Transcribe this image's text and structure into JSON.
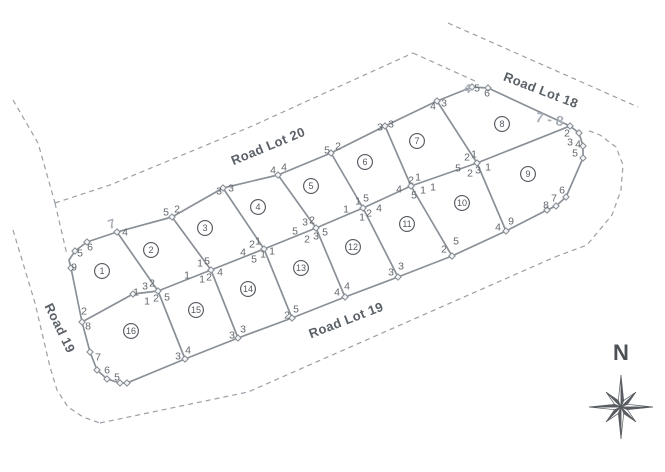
{
  "page": {
    "background": "#ffffff"
  },
  "colors": {
    "line": "#8a9097",
    "dashed": "#9aa0a7",
    "marker_fill": "#f6f7f8",
    "corner_text": "#62676d",
    "lot_text": "#54585e",
    "road_text": "#5a6067",
    "handwritten": "#aab0b8",
    "compass": "#595d62"
  },
  "roads": [
    {
      "label": "Road Lot 20",
      "x": 268,
      "y": 146,
      "rot": -22.5
    },
    {
      "label": "Road Lot 18",
      "x": 541,
      "y": 90,
      "rot": 21
    },
    {
      "label": "Road Lot 19",
      "x": 346,
      "y": 320,
      "rot": -21
    },
    {
      "label": "Road 19",
      "x": 60,
      "y": 328,
      "rot": 64
    }
  ],
  "compass": {
    "label": "N",
    "cx": 621,
    "cy": 407,
    "label_x": 621,
    "label_y": 353,
    "r_long": 32,
    "r_short": 21,
    "r_base": 7
  },
  "lots": [
    {
      "n": "1",
      "x": 102,
      "y": 271
    },
    {
      "n": "2",
      "x": 151,
      "y": 250
    },
    {
      "n": "3",
      "x": 205,
      "y": 228
    },
    {
      "n": "4",
      "x": 258,
      "y": 207
    },
    {
      "n": "5",
      "x": 311,
      "y": 186
    },
    {
      "n": "6",
      "x": 365,
      "y": 162
    },
    {
      "n": "7",
      "x": 417,
      "y": 141
    },
    {
      "n": "8",
      "x": 502,
      "y": 124
    },
    {
      "n": "9",
      "x": 528,
      "y": 174
    },
    {
      "n": "10",
      "x": 462,
      "y": 203
    },
    {
      "n": "11",
      "x": 407,
      "y": 224
    },
    {
      "n": "12",
      "x": 353,
      "y": 247
    },
    {
      "n": "13",
      "x": 301,
      "y": 268
    },
    {
      "n": "14",
      "x": 248,
      "y": 289
    },
    {
      "n": "15",
      "x": 196,
      "y": 310
    },
    {
      "n": "16",
      "x": 131,
      "y": 331
    }
  ],
  "corner_labels": [
    {
      "x": 80,
      "y": 253,
      "t": "5"
    },
    {
      "x": 90,
      "y": 247,
      "t": "6"
    },
    {
      "x": 74,
      "y": 267,
      "t": "9"
    },
    {
      "x": 125,
      "y": 232,
      "t": "4"
    },
    {
      "x": 166,
      "y": 212,
      "t": "5"
    },
    {
      "x": 177,
      "y": 209,
      "t": "2"
    },
    {
      "x": 219,
      "y": 191,
      "t": "3"
    },
    {
      "x": 231,
      "y": 188,
      "t": "3"
    },
    {
      "x": 273,
      "y": 170,
      "t": "4"
    },
    {
      "x": 284,
      "y": 167,
      "t": "4"
    },
    {
      "x": 327,
      "y": 150,
      "t": "5"
    },
    {
      "x": 338,
      "y": 146,
      "t": "2"
    },
    {
      "x": 380,
      "y": 127,
      "t": "3"
    },
    {
      "x": 391,
      "y": 124,
      "t": "3"
    },
    {
      "x": 433,
      "y": 106,
      "t": "4"
    },
    {
      "x": 444,
      "y": 103,
      "t": "3"
    },
    {
      "x": 477,
      "y": 88,
      "t": "5"
    },
    {
      "x": 487,
      "y": 93,
      "t": "6"
    },
    {
      "x": 567,
      "y": 133,
      "t": "2"
    },
    {
      "x": 570,
      "y": 142,
      "t": "3"
    },
    {
      "x": 578,
      "y": 144,
      "t": "4"
    },
    {
      "x": 575,
      "y": 153,
      "t": "5"
    },
    {
      "x": 562,
      "y": 190,
      "t": "6"
    },
    {
      "x": 554,
      "y": 198,
      "t": "7"
    },
    {
      "x": 546,
      "y": 205,
      "t": "8"
    },
    {
      "x": 511,
      "y": 221,
      "t": "9"
    },
    {
      "x": 498,
      "y": 227,
      "t": "4"
    },
    {
      "x": 456,
      "y": 241,
      "t": "5"
    },
    {
      "x": 444,
      "y": 249,
      "t": "2"
    },
    {
      "x": 401,
      "y": 266,
      "t": "3"
    },
    {
      "x": 391,
      "y": 272,
      "t": "3"
    },
    {
      "x": 347,
      "y": 286,
      "t": "4"
    },
    {
      "x": 337,
      "y": 292,
      "t": "4"
    },
    {
      "x": 296,
      "y": 309,
      "t": "5"
    },
    {
      "x": 287,
      "y": 315,
      "t": "2"
    },
    {
      "x": 243,
      "y": 329,
      "t": "3"
    },
    {
      "x": 232,
      "y": 335,
      "t": "3"
    },
    {
      "x": 188,
      "y": 350,
      "t": "4"
    },
    {
      "x": 178,
      "y": 356,
      "t": "3"
    },
    {
      "x": 117,
      "y": 377,
      "t": "5"
    },
    {
      "x": 107,
      "y": 370,
      "t": "6"
    },
    {
      "x": 98,
      "y": 357,
      "t": "7"
    },
    {
      "x": 88,
      "y": 326,
      "t": "8"
    },
    {
      "x": 84,
      "y": 311,
      "t": "2"
    },
    {
      "x": 136,
      "y": 292,
      "t": "1"
    },
    {
      "x": 145,
      "y": 286,
      "t": "3"
    },
    {
      "x": 152,
      "y": 283,
      "t": "2"
    },
    {
      "x": 147,
      "y": 301,
      "t": "1"
    },
    {
      "x": 156,
      "y": 298,
      "t": "2"
    },
    {
      "x": 167,
      "y": 297,
      "t": "5"
    },
    {
      "x": 187,
      "y": 275,
      "t": "1"
    },
    {
      "x": 200,
      "y": 263,
      "t": "1"
    },
    {
      "x": 207,
      "y": 261,
      "t": "5"
    },
    {
      "x": 202,
      "y": 279,
      "t": "1"
    },
    {
      "x": 209,
      "y": 277,
      "t": "2"
    },
    {
      "x": 220,
      "y": 272,
      "t": "4"
    },
    {
      "x": 252,
      "y": 244,
      "t": "2"
    },
    {
      "x": 258,
      "y": 241,
      "t": "1"
    },
    {
      "x": 243,
      "y": 252,
      "t": "4"
    },
    {
      "x": 254,
      "y": 259,
      "t": "5"
    },
    {
      "x": 263,
      "y": 254,
      "t": "1"
    },
    {
      "x": 272,
      "y": 251,
      "t": "1"
    },
    {
      "x": 305,
      "y": 222,
      "t": "3"
    },
    {
      "x": 312,
      "y": 220,
      "t": "2"
    },
    {
      "x": 295,
      "y": 231,
      "t": "5"
    },
    {
      "x": 307,
      "y": 239,
      "t": "2"
    },
    {
      "x": 316,
      "y": 236,
      "t": "3"
    },
    {
      "x": 325,
      "y": 232,
      "t": "5"
    },
    {
      "x": 346,
      "y": 209,
      "t": "1"
    },
    {
      "x": 358,
      "y": 201,
      "t": "1"
    },
    {
      "x": 366,
      "y": 198,
      "t": "5"
    },
    {
      "x": 362,
      "y": 217,
      "t": "1"
    },
    {
      "x": 369,
      "y": 213,
      "t": "2"
    },
    {
      "x": 379,
      "y": 208,
      "t": "4"
    },
    {
      "x": 411,
      "y": 180,
      "t": "2"
    },
    {
      "x": 418,
      "y": 177,
      "t": "1"
    },
    {
      "x": 399,
      "y": 189,
      "t": "4"
    },
    {
      "x": 414,
      "y": 195,
      "t": "5"
    },
    {
      "x": 423,
      "y": 190,
      "t": "1"
    },
    {
      "x": 433,
      "y": 187,
      "t": "1"
    },
    {
      "x": 467,
      "y": 157,
      "t": "2"
    },
    {
      "x": 474,
      "y": 154,
      "t": "1"
    },
    {
      "x": 458,
      "y": 168,
      "t": "5"
    },
    {
      "x": 470,
      "y": 173,
      "t": "2"
    },
    {
      "x": 478,
      "y": 170,
      "t": "3"
    },
    {
      "x": 488,
      "y": 167,
      "t": "1"
    }
  ],
  "handwritten": [
    {
      "x": 113,
      "y": 228,
      "t": "7",
      "rot": -18,
      "size": 13
    },
    {
      "x": 467,
      "y": 93,
      "t": "4",
      "rot": 5,
      "size": 13
    },
    {
      "x": 549,
      "y": 124,
      "t": "7 - 8",
      "rot": 9,
      "size": 14
    }
  ],
  "geometry": {
    "solid": [
      [
        [
          71,
          268
        ],
        [
          69,
          260
        ],
        [
          75,
          251
        ],
        [
          87,
          242
        ],
        [
          117,
          232
        ],
        [
          172,
          217
        ],
        [
          223,
          188
        ],
        [
          278,
          175
        ],
        [
          331,
          153
        ],
        [
          385,
          126
        ],
        [
          437,
          101
        ],
        [
          472,
          87
        ],
        [
          488,
          88
        ],
        [
          570,
          126
        ]
      ],
      [
        [
          71,
          268
        ],
        [
          82,
          322
        ],
        [
          90,
          352
        ],
        [
          97,
          370
        ],
        [
          107,
          379
        ],
        [
          120,
          383
        ],
        [
          127,
          383
        ],
        [
          185,
          359
        ],
        [
          238,
          338
        ],
        [
          292,
          318
        ],
        [
          345,
          297
        ],
        [
          398,
          277
        ],
        [
          452,
          256
        ],
        [
          506,
          231
        ],
        [
          547,
          210
        ],
        [
          556,
          206
        ],
        [
          566,
          197
        ],
        [
          583,
          158
        ],
        [
          583,
          146
        ],
        [
          579,
          133
        ],
        [
          570,
          126
        ]
      ],
      [
        [
          82,
          322
        ],
        [
          133,
          294
        ],
        [
          158,
          291
        ],
        [
          211,
          270
        ],
        [
          264,
          249
        ],
        [
          316,
          228
        ],
        [
          363,
          208
        ],
        [
          411,
          186
        ],
        [
          477,
          163
        ],
        [
          570,
          126
        ]
      ],
      [
        [
          117,
          232
        ],
        [
          158,
          291
        ]
      ],
      [
        [
          172,
          217
        ],
        [
          211,
          270
        ]
      ],
      [
        [
          223,
          188
        ],
        [
          264,
          249
        ]
      ],
      [
        [
          278,
          175
        ],
        [
          316,
          228
        ]
      ],
      [
        [
          331,
          153
        ],
        [
          363,
          208
        ]
      ],
      [
        [
          385,
          126
        ],
        [
          411,
          186
        ]
      ],
      [
        [
          437,
          101
        ],
        [
          477,
          163
        ]
      ],
      [
        [
          158,
          291
        ],
        [
          185,
          359
        ]
      ],
      [
        [
          211,
          270
        ],
        [
          238,
          338
        ]
      ],
      [
        [
          264,
          249
        ],
        [
          292,
          318
        ]
      ],
      [
        [
          316,
          228
        ],
        [
          345,
          297
        ]
      ],
      [
        [
          363,
          208
        ],
        [
          398,
          277
        ]
      ],
      [
        [
          411,
          186
        ],
        [
          452,
          256
        ]
      ],
      [
        [
          477,
          163
        ],
        [
          506,
          231
        ]
      ]
    ],
    "dashed": [
      [
        [
          13,
          100
        ],
        [
          38,
          143
        ],
        [
          55,
          203
        ]
      ],
      [
        [
          55,
          203
        ],
        [
          110,
          185
        ],
        [
          250,
          127
        ],
        [
          413,
          53
        ]
      ],
      [
        [
          55,
          203
        ],
        [
          67,
          255
        ]
      ],
      [
        [
          413,
          53
        ],
        [
          475,
          81
        ]
      ],
      [
        [
          448,
          23
        ],
        [
          638,
          107
        ]
      ],
      [
        [
          13,
          230
        ],
        [
          35,
          303
        ],
        [
          50,
          367
        ],
        [
          57,
          390
        ],
        [
          68,
          407
        ],
        [
          83,
          417
        ],
        [
          100,
          423
        ]
      ],
      [
        [
          100,
          423
        ],
        [
          248,
          392
        ],
        [
          555,
          257
        ]
      ],
      [
        [
          555,
          257
        ],
        [
          587,
          245
        ],
        [
          612,
          215
        ],
        [
          621,
          190
        ],
        [
          623,
          165
        ],
        [
          616,
          147
        ],
        [
          600,
          135
        ],
        [
          587,
          130
        ]
      ]
    ],
    "markers": [
      [
        71,
        268
      ],
      [
        75,
        251
      ],
      [
        87,
        242
      ],
      [
        117,
        232
      ],
      [
        172,
        217
      ],
      [
        223,
        188
      ],
      [
        278,
        175
      ],
      [
        331,
        153
      ],
      [
        385,
        126
      ],
      [
        437,
        101
      ],
      [
        472,
        87
      ],
      [
        488,
        88
      ],
      [
        570,
        126
      ],
      [
        579,
        133
      ],
      [
        583,
        146
      ],
      [
        583,
        158
      ],
      [
        566,
        197
      ],
      [
        556,
        206
      ],
      [
        547,
        210
      ],
      [
        506,
        231
      ],
      [
        452,
        256
      ],
      [
        398,
        277
      ],
      [
        345,
        297
      ],
      [
        292,
        318
      ],
      [
        238,
        338
      ],
      [
        185,
        359
      ],
      [
        127,
        383
      ],
      [
        120,
        383
      ],
      [
        107,
        379
      ],
      [
        97,
        370
      ],
      [
        90,
        352
      ],
      [
        82,
        322
      ],
      [
        133,
        294
      ],
      [
        158,
        291
      ],
      [
        211,
        270
      ],
      [
        264,
        249
      ],
      [
        316,
        228
      ],
      [
        363,
        208
      ],
      [
        411,
        186
      ],
      [
        477,
        163
      ]
    ]
  }
}
